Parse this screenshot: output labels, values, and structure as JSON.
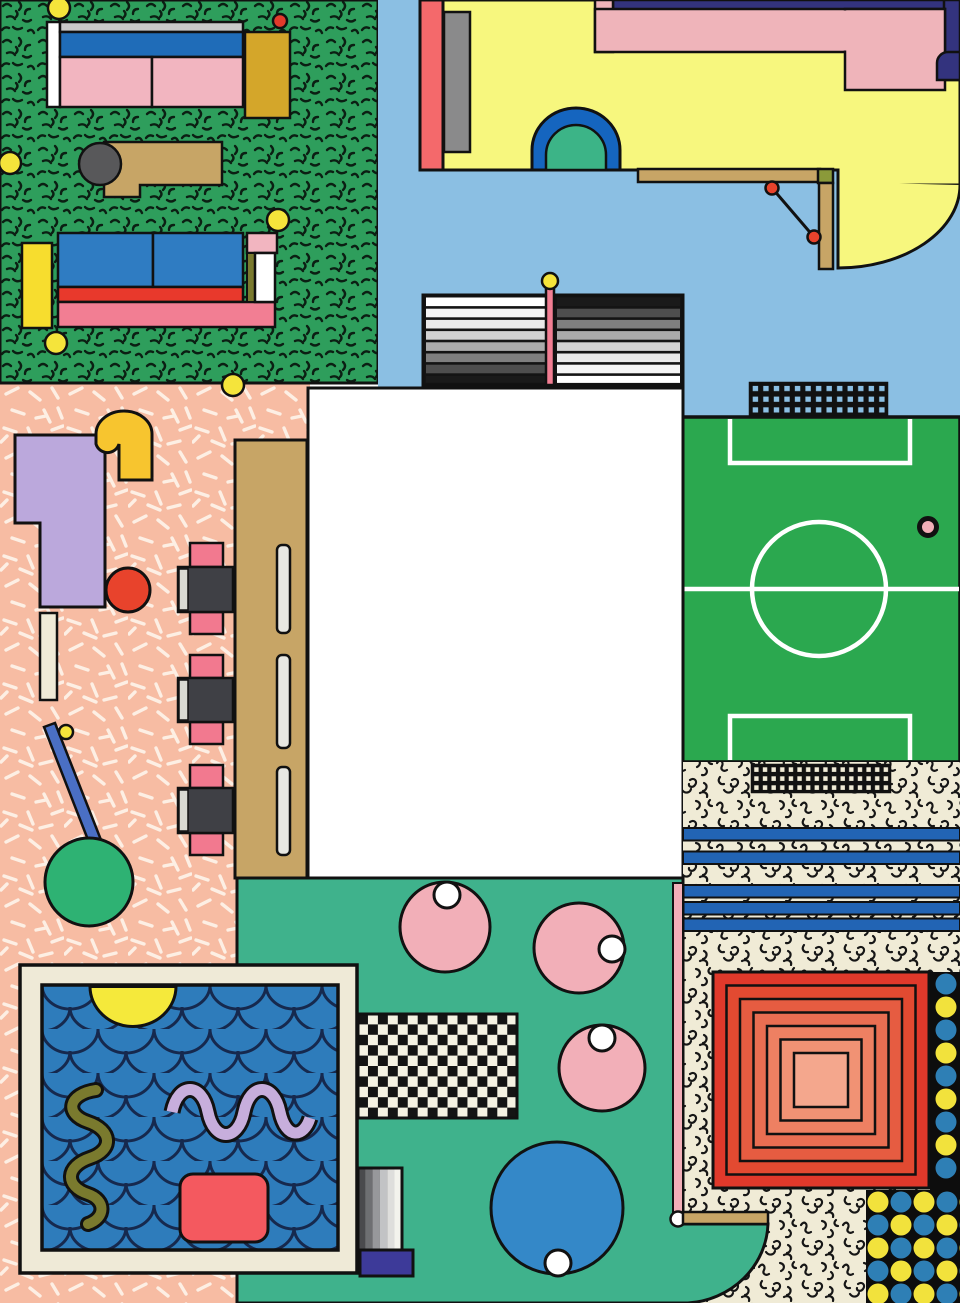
{
  "artwork": {
    "kind": "memphis-style-overhead-room-illustration",
    "canvas": {
      "width": 960,
      "height": 1303
    },
    "palette": {
      "speckle_green": "#2E9E5C",
      "pitch_green": "#2BA84F",
      "sky_blue": "#8BBFE3",
      "salmon": "#F7BCA3",
      "cream": "#F0EBD6",
      "teal": "#3FB28C",
      "pale_yellow": "#F7F77E",
      "navy": "#33337E",
      "band_pink": "#EFB4BA",
      "coral": "#F4696B",
      "lavender": "#BBA8DC",
      "gold": "#D4A62A",
      "bright_yellow": "#F7C52F",
      "tan": "#C7A566",
      "chair_pink": "#F2798F",
      "cushion_pink": "#F2B5C0",
      "seat_gray": "#3F4045",
      "pool_blue": "#2E7CBB",
      "scallop_navy": "#16294E",
      "circle_pink": "#F2AFB8",
      "table_blue": "#3488C8",
      "red_orange": "#E8432C",
      "rug_red_outer": "#E0392B",
      "rug_red_inner": "#F4A78D",
      "dot_yellow": "#F2E23C",
      "dot_blue": "#2E7FB5",
      "ink_black": "#111111",
      "olive": "#7A7A2E",
      "indigo": "#3D3A99",
      "lilac": "#C7AEDC",
      "stripe_blue": "#2264B4",
      "arch_blue": "#1565BF",
      "arch_green": "#3CB487",
      "white": "#FFFFFF"
    },
    "regions": [
      {
        "id": "lounge",
        "desc": "green speckled lounge with two sofas and bench",
        "fill": "speckle-pattern"
      },
      {
        "id": "deck",
        "desc": "light blue deck with yellow terrace, arch and shelf",
        "fill": "sky_blue"
      },
      {
        "id": "dining",
        "desc": "salmon confetti dining area with long table and chairs",
        "fill": "confetti-pattern"
      },
      {
        "id": "pitch",
        "desc": "soccer field with goal nets",
        "fill": "pitch_green"
      },
      {
        "id": "court",
        "desc": "teal court with round tables and checker mat",
        "fill": "teal"
      },
      {
        "id": "carpet",
        "desc": "cream squiggle carpet with blue stripes and concentric rug",
        "fill": "squiggle-pattern"
      },
      {
        "id": "pool",
        "desc": "framed swimming pool with scallop water",
        "fill": "scallop-pattern"
      },
      {
        "id": "blank_card",
        "desc": "empty white rectangle",
        "fill": "white"
      }
    ],
    "objects": [
      "sofa-top",
      "bench-with-stool",
      "sofa-bottom",
      "yellow-dots",
      "tv-screen",
      "arch-door",
      "wall-shelf-with-bracket",
      "striped-awning",
      "goal-net-top",
      "goal-net-mid",
      "center-circle",
      "penalty-boxes",
      "ball",
      "long-table",
      "three-chairs",
      "lavender-counter",
      "yellow-hook-flag",
      "red-stool",
      "sign-stick-with-green-balloon",
      "round-table-pink-1",
      "round-table-pink-2",
      "round-table-pink-3",
      "round-table-blue",
      "checker-mat",
      "striped-doormat",
      "indigo-step",
      "concentric-rug",
      "dot-column",
      "dot-grid-corner",
      "pool-frame",
      "pool-water",
      "sun-half-disc",
      "olive-squiggle",
      "lilac-wave",
      "red-float"
    ]
  }
}
